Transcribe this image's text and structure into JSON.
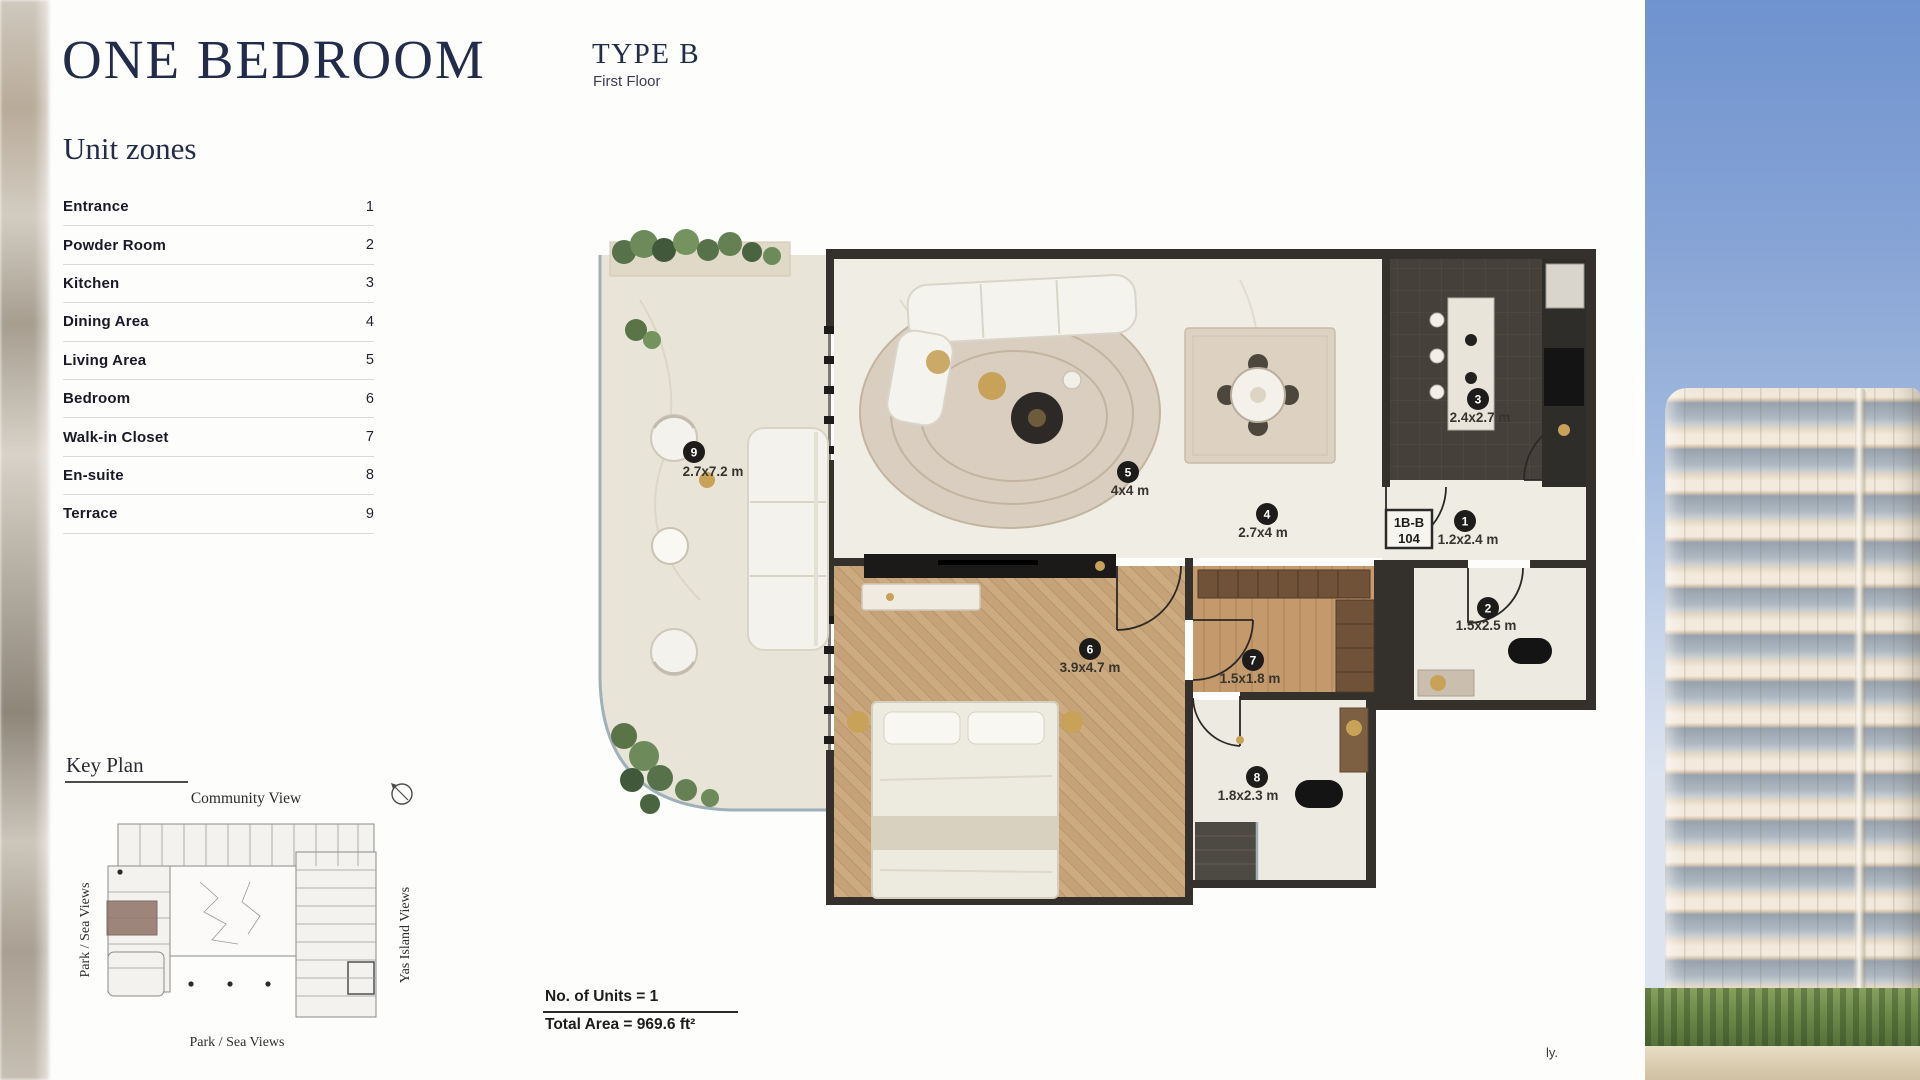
{
  "header": {
    "title": "ONE BEDROOM",
    "type_label": "TYPE B",
    "floor_label": "First Floor"
  },
  "unit_zones": {
    "heading": "Unit zones",
    "items": [
      {
        "label": "Entrance",
        "num": "1"
      },
      {
        "label": "Powder Room",
        "num": "2"
      },
      {
        "label": "Kitchen",
        "num": "3"
      },
      {
        "label": "Dining Area",
        "num": "4"
      },
      {
        "label": "Living Area",
        "num": "5"
      },
      {
        "label": "Bedroom",
        "num": "6"
      },
      {
        "label": "Walk-in Closet",
        "num": "7"
      },
      {
        "label": "En-suite",
        "num": "8"
      },
      {
        "label": "Terrace",
        "num": "9"
      }
    ]
  },
  "key_plan": {
    "heading": "Key Plan",
    "top_label": "Community View",
    "left_label": "Park / Sea Views",
    "right_label": "Yas Island Views",
    "bottom_label": "Park / Sea Views"
  },
  "floor_plan": {
    "unit_code": "1B-B",
    "unit_number": "104",
    "annotations": [
      {
        "num": "1",
        "dim": "1.2x2.4 m"
      },
      {
        "num": "2",
        "dim": "1.5x2.5 m"
      },
      {
        "num": "3",
        "dim": "2.4x2.7 m"
      },
      {
        "num": "4",
        "dim": "2.7x4 m"
      },
      {
        "num": "5",
        "dim": "4x4 m"
      },
      {
        "num": "6",
        "dim": "3.9x4.7 m"
      },
      {
        "num": "7",
        "dim": "1.5x1.8 m"
      },
      {
        "num": "8",
        "dim": "1.8x2.3 m"
      },
      {
        "num": "9",
        "dim": "2.7x7.2 m"
      }
    ]
  },
  "summary": {
    "units_line": "No. of Units = 1",
    "area_line": "Total Area = 969.6 ft²"
  },
  "footer": {
    "truncated_text": "ly."
  },
  "colors": {
    "accent_navy": "#222b49",
    "wall": "#34312c",
    "marble": "#f0ede5",
    "terrace": "#e9e4d8",
    "wood": "#c5a277",
    "kitchen_floor": "#454139",
    "badge": "#1d1c1a",
    "keyplan_highlight": "#8f7268",
    "gold": "#c7a258"
  }
}
